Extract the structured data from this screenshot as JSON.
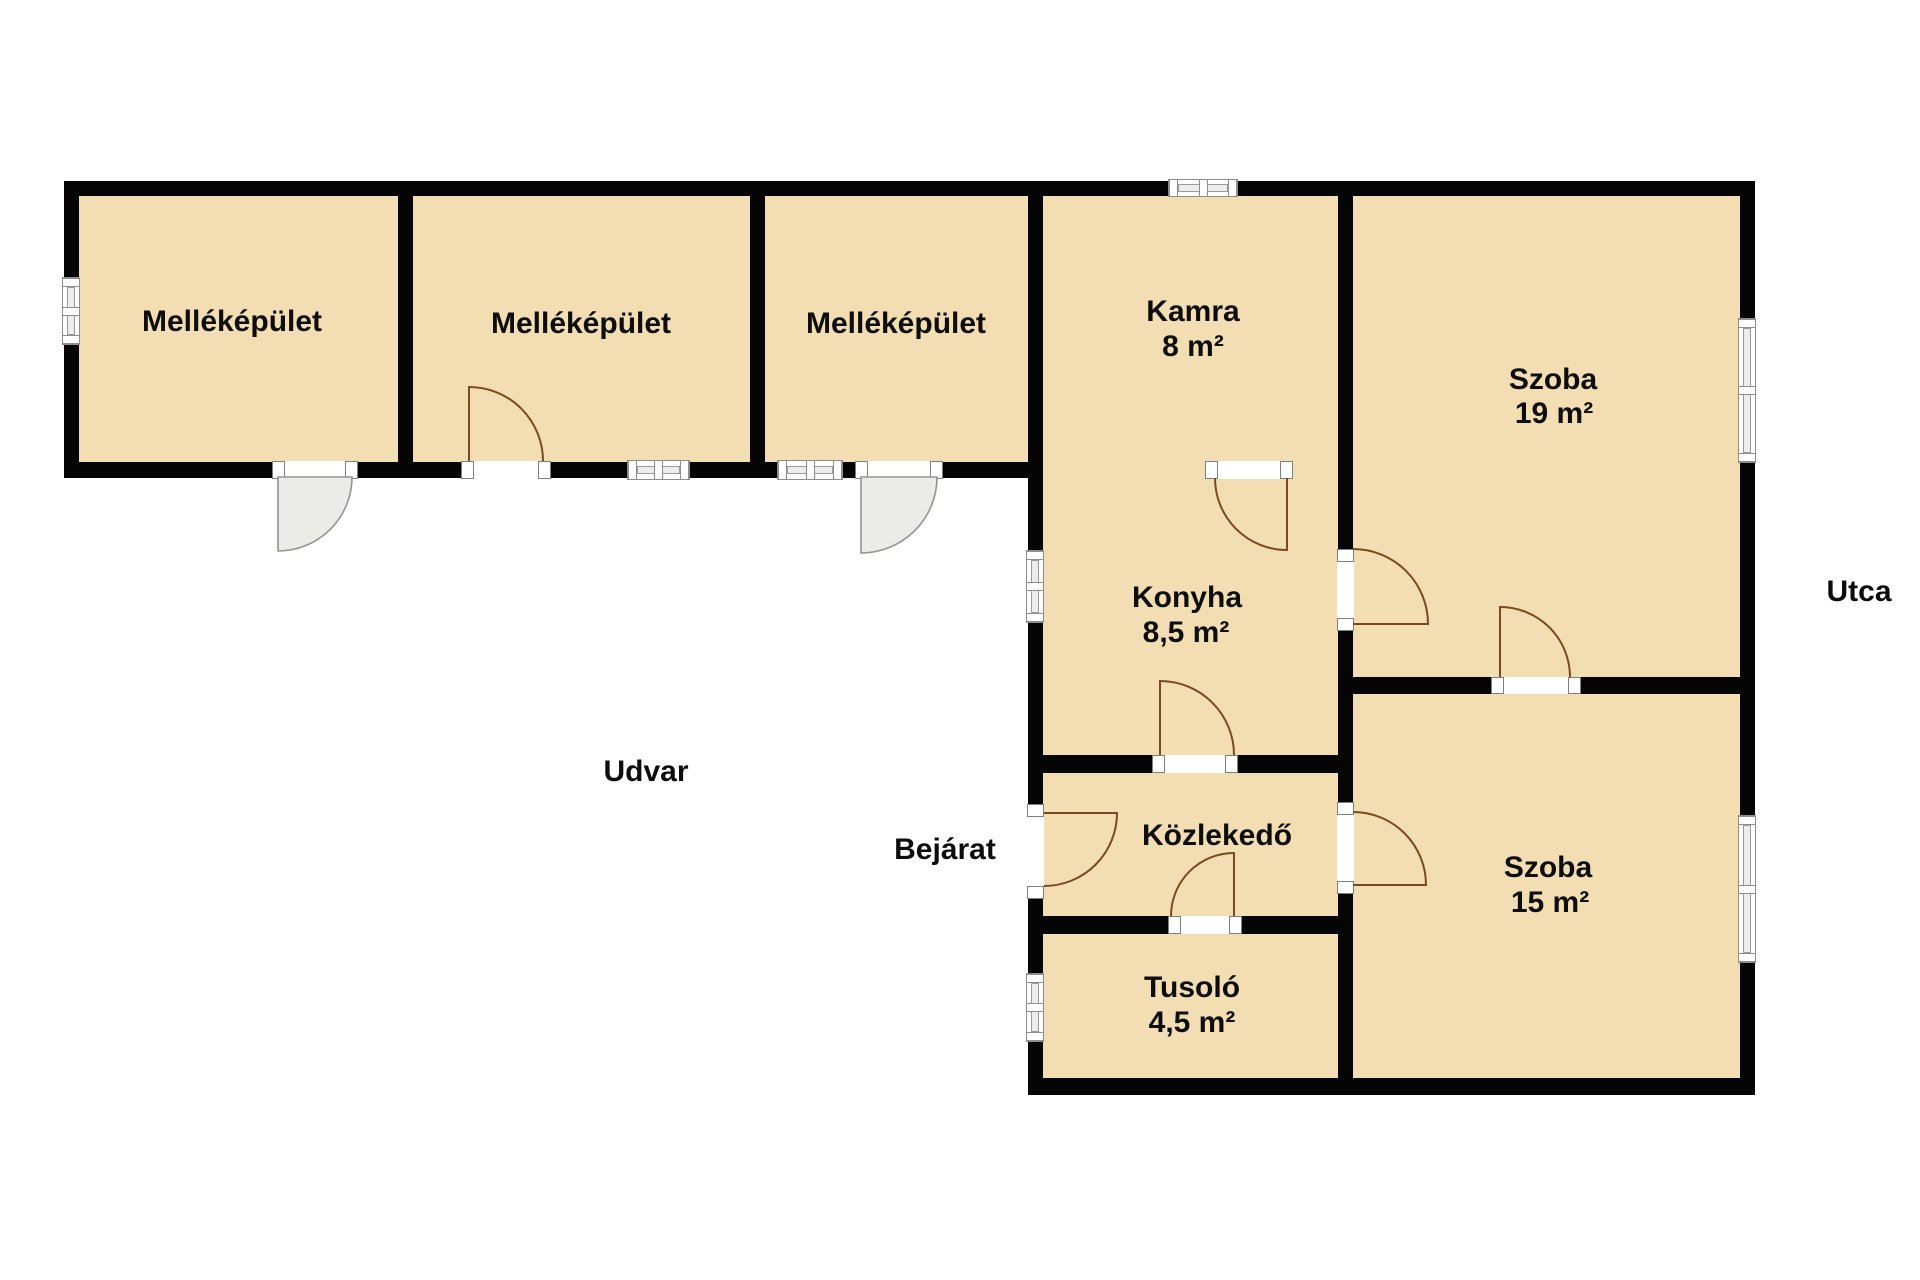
{
  "title": "Floor plan",
  "colors": {
    "background": "#ffffff",
    "room_fill": "#f3deb3",
    "wall": "#050505",
    "window_border": "#8e8e8e",
    "glass_fill": "#ededed",
    "door_arc": "#7a4a1f",
    "exterior_door_fill": "#ebebe7",
    "exterior_door_stroke": "#939393",
    "label_color": "#0d0d0d"
  },
  "canvas": {
    "width": 1920,
    "height": 1280
  },
  "labels": [
    {
      "name": "label-mellekepulet-1",
      "text": "Melléképület",
      "x": 232,
      "y": 322,
      "size": 30
    },
    {
      "name": "label-mellekepulet-2",
      "text": "Melléképület",
      "x": 581,
      "y": 324,
      "size": 30
    },
    {
      "name": "label-mellekepulet-3",
      "text": "Melléképület",
      "x": 896,
      "y": 324,
      "size": 30
    },
    {
      "name": "label-kamra",
      "text": "Kamra",
      "x": 1193,
      "y": 312,
      "size": 30
    },
    {
      "name": "label-kamra-area",
      "text": "8 m²",
      "x": 1193,
      "y": 347,
      "size": 30
    },
    {
      "name": "label-szoba-19",
      "text": "Szoba",
      "x": 1553,
      "y": 380,
      "size": 30
    },
    {
      "name": "label-szoba-19-area",
      "text": "19 m²",
      "x": 1554,
      "y": 414,
      "size": 30
    },
    {
      "name": "label-konyha",
      "text": "Konyha",
      "x": 1187,
      "y": 598,
      "size": 30
    },
    {
      "name": "label-konyha-area",
      "text": "8,5 m²",
      "x": 1186,
      "y": 633,
      "size": 30
    },
    {
      "name": "label-kozlekedo",
      "text": "Közlekedő",
      "x": 1217,
      "y": 836,
      "size": 30
    },
    {
      "name": "label-tusolo",
      "text": "Tusoló",
      "x": 1192,
      "y": 988,
      "size": 30
    },
    {
      "name": "label-tusolo-area",
      "text": "4,5 m²",
      "x": 1192,
      "y": 1023,
      "size": 30
    },
    {
      "name": "label-szoba-15",
      "text": "Szoba",
      "x": 1548,
      "y": 868,
      "size": 30
    },
    {
      "name": "label-szoba-15-area",
      "text": "15 m²",
      "x": 1550,
      "y": 903,
      "size": 30
    },
    {
      "name": "label-udvar",
      "text": "Udvar",
      "x": 646,
      "y": 772,
      "size": 30
    },
    {
      "name": "label-bejarat",
      "text": "Bejárat",
      "x": 945,
      "y": 850,
      "size": 30
    },
    {
      "name": "label-utca",
      "text": "Utca",
      "x": 1859,
      "y": 592,
      "size": 30
    }
  ],
  "plan": {
    "floor_rects": [
      {
        "name": "floor-upper-strip",
        "x": 72,
        "y": 188,
        "w": 1676,
        "h": 282
      },
      {
        "name": "floor-lower-wing",
        "x": 1036,
        "y": 462,
        "w": 712,
        "h": 624
      }
    ],
    "walls": [
      {
        "name": "wall-outer-top",
        "x": 64,
        "y": 181,
        "w": 1691,
        "h": 15
      },
      {
        "name": "wall-outer-left",
        "x": 64,
        "y": 181,
        "w": 15,
        "h": 297
      },
      {
        "name": "wall-strip-bottom",
        "x": 64,
        "y": 462,
        "w": 979,
        "h": 16
      },
      {
        "name": "wall-outer-right",
        "x": 1740,
        "y": 181,
        "w": 15,
        "h": 914
      },
      {
        "name": "wall-outer-bottom",
        "x": 1028,
        "y": 1078,
        "w": 727,
        "h": 17
      },
      {
        "name": "wall-lower-left",
        "x": 1028,
        "y": 181,
        "w": 15,
        "h": 914
      },
      {
        "name": "wall-divider-1",
        "x": 398,
        "y": 181,
        "w": 15,
        "h": 297
      },
      {
        "name": "wall-divider-2",
        "x": 750,
        "y": 181,
        "w": 15,
        "h": 297
      },
      {
        "name": "wall-divider-4",
        "x": 1338,
        "y": 181,
        "w": 15,
        "h": 914
      },
      {
        "name": "wall-szoba19-szoba15",
        "x": 1353,
        "y": 677,
        "w": 387,
        "h": 17
      },
      {
        "name": "wall-konyha-kozlekedo",
        "x": 1043,
        "y": 755,
        "w": 295,
        "h": 18
      },
      {
        "name": "wall-kozlekedo-tusolo",
        "x": 1043,
        "y": 916,
        "w": 295,
        "h": 18
      }
    ],
    "windows": [
      {
        "name": "window-mellekepulet1-left",
        "x": 62,
        "y": 277,
        "w": 18,
        "h": 68,
        "o": "v"
      },
      {
        "name": "window-mellekepulet2-bottom",
        "x": 627,
        "y": 460,
        "w": 63,
        "h": 20,
        "o": "h"
      },
      {
        "name": "window-mellekepulet3-bottom",
        "x": 777,
        "y": 460,
        "w": 66,
        "h": 20,
        "o": "h"
      },
      {
        "name": "window-kamra-top",
        "x": 1168,
        "y": 179,
        "w": 70,
        "h": 18,
        "o": "h"
      },
      {
        "name": "window-szoba19-right",
        "x": 1738,
        "y": 318,
        "w": 18,
        "h": 145,
        "o": "v"
      },
      {
        "name": "window-konyha-left",
        "x": 1026,
        "y": 550,
        "w": 18,
        "h": 73,
        "o": "v"
      },
      {
        "name": "window-tusolo-left",
        "x": 1026,
        "y": 973,
        "w": 18,
        "h": 69,
        "o": "v"
      },
      {
        "name": "window-szoba15-right",
        "x": 1738,
        "y": 815,
        "w": 18,
        "h": 148,
        "o": "v"
      }
    ],
    "door_gaps": [
      {
        "name": "doorgap-mellekepulet1",
        "x": 272,
        "y": 461,
        "w": 86,
        "h": 18,
        "o": "h"
      },
      {
        "name": "doorgap-mellekepulet2",
        "x": 461,
        "y": 461,
        "w": 90,
        "h": 18,
        "o": "h"
      },
      {
        "name": "doorgap-mellekepulet3",
        "x": 855,
        "y": 461,
        "w": 88,
        "h": 18,
        "o": "h"
      },
      {
        "name": "doorgap-kamra-konyha",
        "x": 1205,
        "y": 461,
        "w": 88,
        "h": 18,
        "o": "h"
      },
      {
        "name": "doorgap-konyha-szoba19",
        "x": 1337,
        "y": 549,
        "w": 17,
        "h": 82,
        "o": "v"
      },
      {
        "name": "doorgap-konyha-kozlekedo",
        "x": 1152,
        "y": 755,
        "w": 86,
        "h": 18,
        "o": "h"
      },
      {
        "name": "doorgap-bejarat",
        "x": 1027,
        "y": 804,
        "w": 17,
        "h": 95,
        "o": "v"
      },
      {
        "name": "doorgap-kozlekedo-tusolo",
        "x": 1168,
        "y": 916,
        "w": 74,
        "h": 18,
        "o": "h"
      },
      {
        "name": "doorgap-kozlekedo-szoba15",
        "x": 1337,
        "y": 802,
        "w": 17,
        "h": 92,
        "o": "v"
      },
      {
        "name": "doorgap-szoba19-szoba15",
        "x": 1491,
        "y": 677,
        "w": 90,
        "h": 17,
        "o": "h"
      }
    ],
    "doors": [
      {
        "name": "door-swing-mellekepulet1",
        "type": "exterior",
        "hinge": [
          278,
          477
        ],
        "leaf": [
          278,
          551
        ],
        "arcEnd": [
          352,
          477
        ],
        "r": 74,
        "sweep": 0
      },
      {
        "name": "door-swing-mellekepulet2",
        "type": "interior",
        "hinge": [
          469,
          461
        ],
        "leaf": [
          469,
          387
        ],
        "arcEnd": [
          543,
          461
        ],
        "r": 74,
        "sweep": 1
      },
      {
        "name": "door-swing-mellekepulet3",
        "type": "exterior",
        "hinge": [
          861,
          477
        ],
        "leaf": [
          861,
          553
        ],
        "arcEnd": [
          937,
          477
        ],
        "r": 76,
        "sweep": 0
      },
      {
        "name": "door-swing-kamra-konyha",
        "type": "interior",
        "hinge": [
          1287,
          478
        ],
        "leaf": [
          1287,
          550
        ],
        "arcEnd": [
          1215,
          478
        ],
        "r": 72,
        "sweep": 1
      },
      {
        "name": "door-swing-konyha-szoba19",
        "type": "interior",
        "hinge": [
          1353,
          624
        ],
        "leaf": [
          1428,
          624
        ],
        "arcEnd": [
          1353,
          549
        ],
        "r": 75,
        "sweep": 0
      },
      {
        "name": "door-swing-konyha-kozlekedo",
        "type": "interior",
        "hinge": [
          1160,
          755
        ],
        "leaf": [
          1160,
          681
        ],
        "arcEnd": [
          1234,
          755
        ],
        "r": 74,
        "sweep": 1
      },
      {
        "name": "door-swing-bejarat",
        "type": "interior",
        "hinge": [
          1044,
          813
        ],
        "leaf": [
          1117,
          813
        ],
        "arcEnd": [
          1044,
          886
        ],
        "r": 73,
        "sweep": 1
      },
      {
        "name": "door-swing-kozlekedo-tusolo",
        "type": "interior",
        "hinge": [
          1234,
          916
        ],
        "leaf": [
          1234,
          853
        ],
        "arcEnd": [
          1171,
          916
        ],
        "r": 63,
        "sweep": 0
      },
      {
        "name": "door-swing-kozlekedo-szoba15",
        "type": "interior",
        "hinge": [
          1353,
          885
        ],
        "leaf": [
          1426,
          885
        ],
        "arcEnd": [
          1353,
          812
        ],
        "r": 73,
        "sweep": 0
      },
      {
        "name": "door-swing-szoba19-szoba15",
        "type": "interior",
        "hinge": [
          1500,
          677
        ],
        "leaf": [
          1500,
          607
        ],
        "arcEnd": [
          1570,
          677
        ],
        "r": 70,
        "sweep": 1
      }
    ]
  }
}
